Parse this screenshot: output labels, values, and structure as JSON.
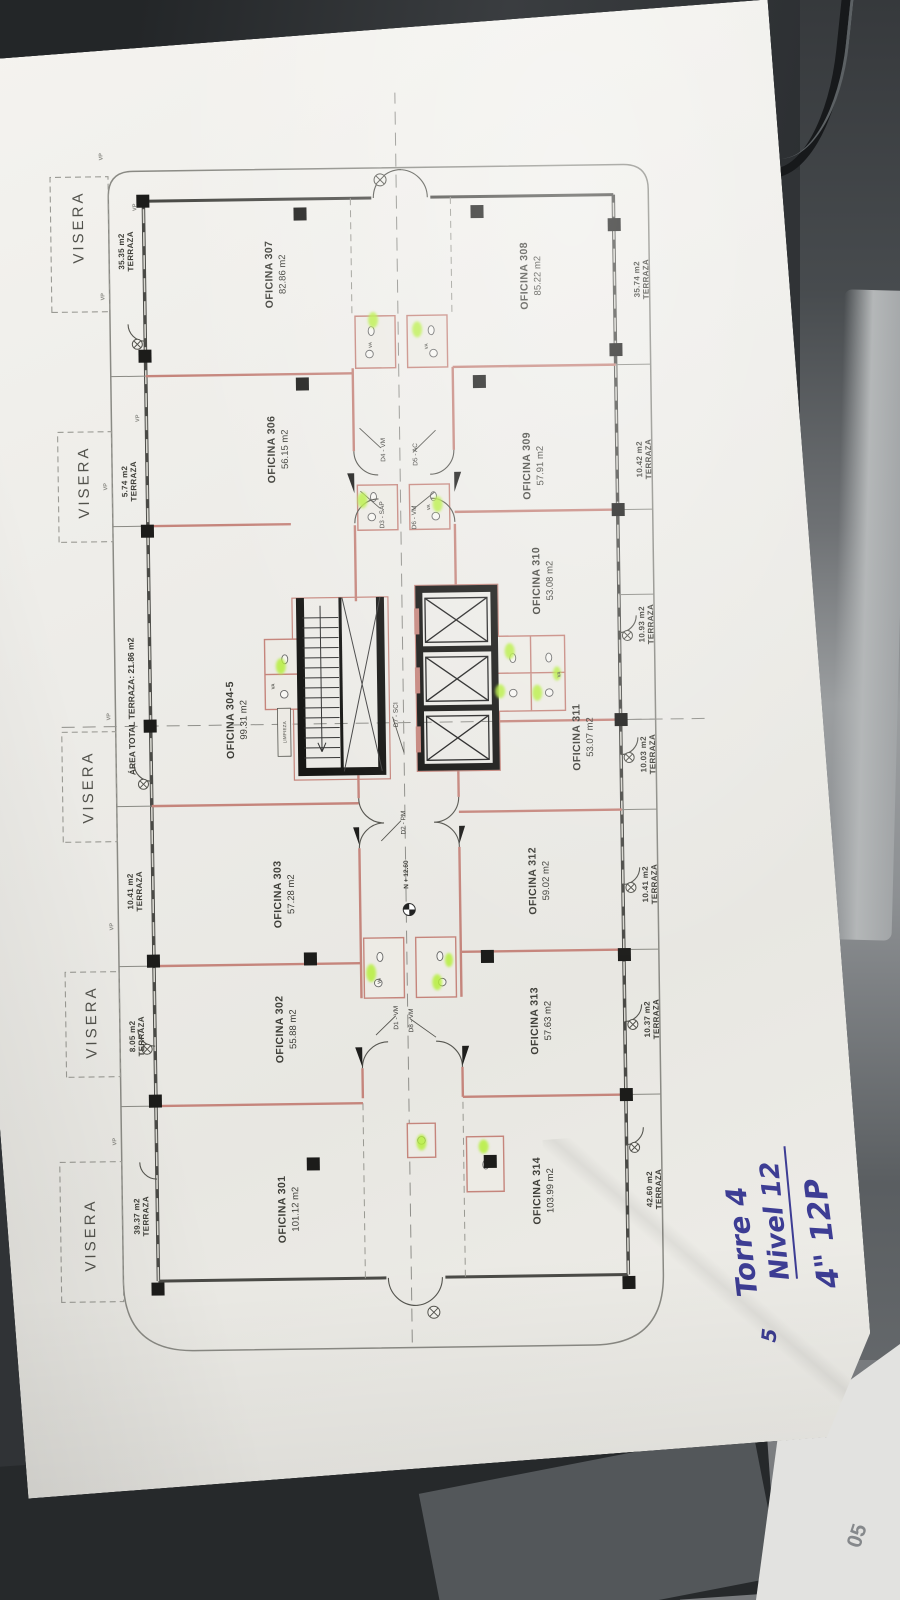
{
  "photo": {
    "corner_sheet_text": "05"
  },
  "handwriting": {
    "line1": "Torre 4",
    "line2": "Nivel 12",
    "line3": "4\" 12P",
    "stray": "5"
  },
  "plan": {
    "visera": "VISERA",
    "terrace_word": "TERRAZA",
    "area_total_terraza": "ÁREA TOTAL TERRAZA: 21.86 m2",
    "level_mark": "N + 12.60",
    "core_room_label": "LIMPIEZA",
    "window_tag": "VP",
    "vent_tag": "VA",
    "offices_top": [
      {
        "name": "OFICINA 307",
        "area": "82.86 m2"
      },
      {
        "name": "OFICINA 306",
        "area": "56.15 m2"
      },
      {
        "name": "OFICINA 304-5",
        "area": "99.31 m2"
      },
      {
        "name": "OFICINA 303",
        "area": "57.28 m2"
      },
      {
        "name": "OFICINA 302",
        "area": "55.88 m2"
      },
      {
        "name": "OFICINA 301",
        "area": "101.12 m2"
      }
    ],
    "offices_bottom": [
      {
        "name": "OFICINA 308",
        "area": "85.22 m2"
      },
      {
        "name": "OFICINA 309",
        "area": "57.91 m2"
      },
      {
        "name": "OFICINA 310",
        "area": "53.08 m2"
      },
      {
        "name": "OFICINA 311",
        "area": "53.07 m2"
      },
      {
        "name": "OFICINA 312",
        "area": "59.02 m2"
      },
      {
        "name": "OFICINA 313",
        "area": "57.63 m2"
      },
      {
        "name": "OFICINA 314",
        "area": "103.99 m2"
      }
    ],
    "terraces_top": [
      "35.35 m2",
      "5.74 m2",
      "10.41 m2",
      "8.05 m2",
      "39.37 m2"
    ],
    "terraces_bottom": [
      "35.74 m2",
      "10.42 m2",
      "10.93 m2",
      "10.03 m2",
      "10.41 m2",
      "10.37 m2",
      "42.60 m2"
    ],
    "doors": [
      "D4 - VM",
      "D5 - AC",
      "D3 - SAP",
      "D6 - VM",
      "D7 - SCI",
      "D2 - PM",
      "D1 - VM",
      "D8 - VM"
    ]
  },
  "colors": {
    "wall_red": "#c5857c",
    "highlight_green": "#b6ef3e",
    "ink_blue": "#3d3d94",
    "line_gray": "#4a4a46"
  }
}
